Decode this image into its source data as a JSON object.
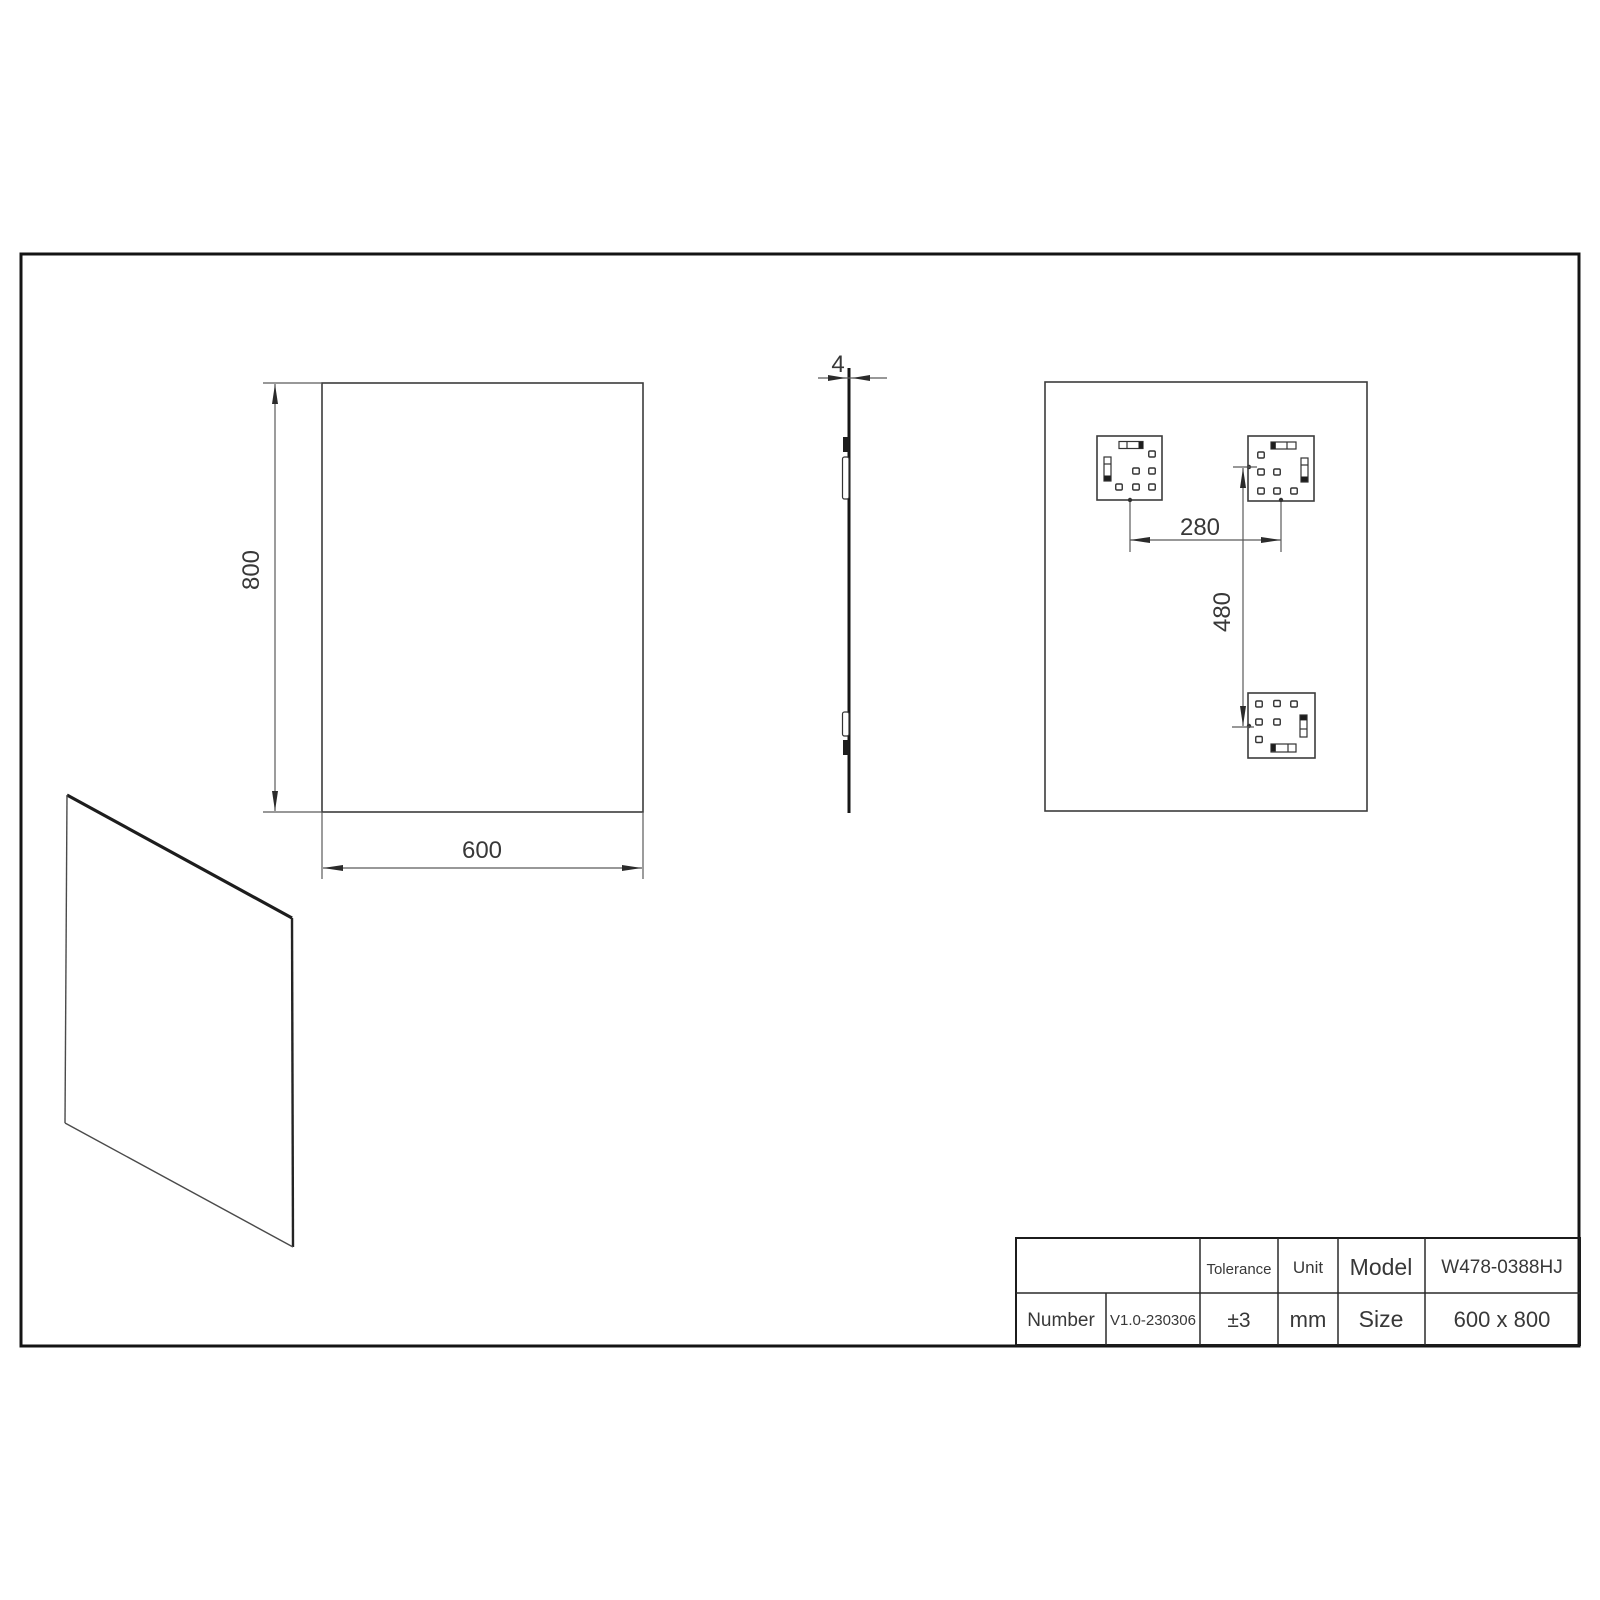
{
  "page": {
    "background_color": "#ffffff",
    "ink_color": "#2b2b2b"
  },
  "views": {
    "front": {
      "height_dim": "800",
      "width_dim": "600"
    },
    "side": {
      "thickness_dim": "4"
    },
    "back": {
      "bracket_spacing_horizontal": "280",
      "bracket_spacing_vertical": "480"
    }
  },
  "title_block": {
    "number_label": "Number",
    "number_value": "V1.0-230306",
    "tolerance_label": "Tolerance",
    "tolerance_value": "±3",
    "unit_label": "Unit",
    "unit_value": "mm",
    "model_label": "Model",
    "model_value": "W478-0388HJ",
    "size_label": "Size",
    "size_value": "600 x 800"
  }
}
